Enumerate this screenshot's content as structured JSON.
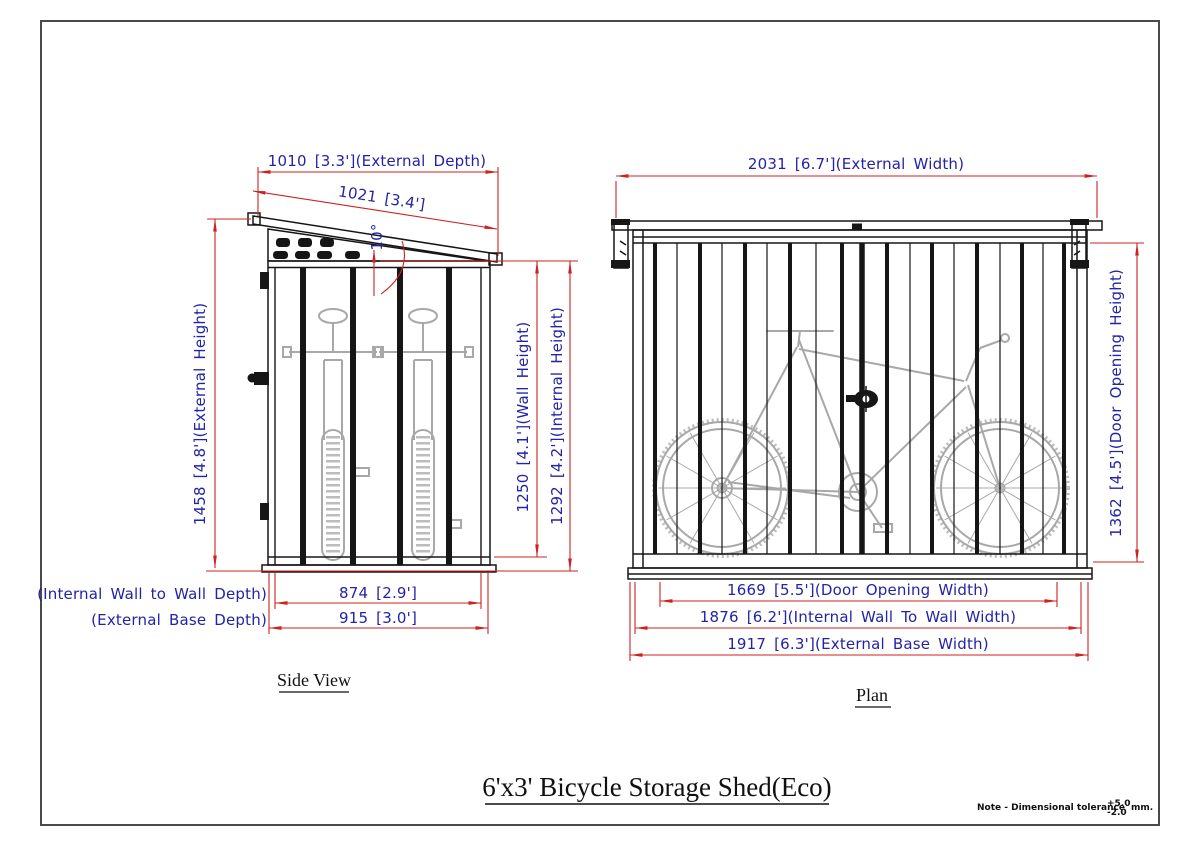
{
  "colors": {
    "dim_line": "#cc2222",
    "dim_text": "#2323a8",
    "ink": "#161616",
    "bike": "#a8a8a8"
  },
  "title": "6'x3' Bicycle Storage Shed(Eco)",
  "side_view": {
    "caption": "Side View",
    "dims": {
      "external_depth": "1010 [3.3'](External Depth)",
      "roof_slope_length": "1021 [3.4']",
      "roof_angle": "10°",
      "external_height": "1458 [4.8'](External Height)",
      "wall_height": "1250 [4.1'](Wall Height)",
      "internal_height": "1292 [4.2'](Internal Height)",
      "internal_depth_label": "(Internal Wall to Wall Depth)",
      "internal_depth_value": "874 [2.9']",
      "external_base_depth_label": "(External Base Depth)",
      "external_base_depth_value": "915 [3.0']"
    }
  },
  "plan_view": {
    "caption": "Plan",
    "dims": {
      "external_width": "2031 [6.7'](External Width)",
      "door_opening_height": "1362 [4.5'](Door Opening Height)",
      "door_opening_width": "1669 [5.5'](Door Opening Width)",
      "internal_width": "1876 [6.2'](Internal Wall To Wall Width)",
      "external_base_width": "1917 [6.3'](External Base Width)"
    }
  },
  "note": {
    "text": "Note - Dimensional tolerance",
    "tolerance_plus": "+5.0",
    "tolerance_minus": "-2.0",
    "unit": "mm."
  }
}
